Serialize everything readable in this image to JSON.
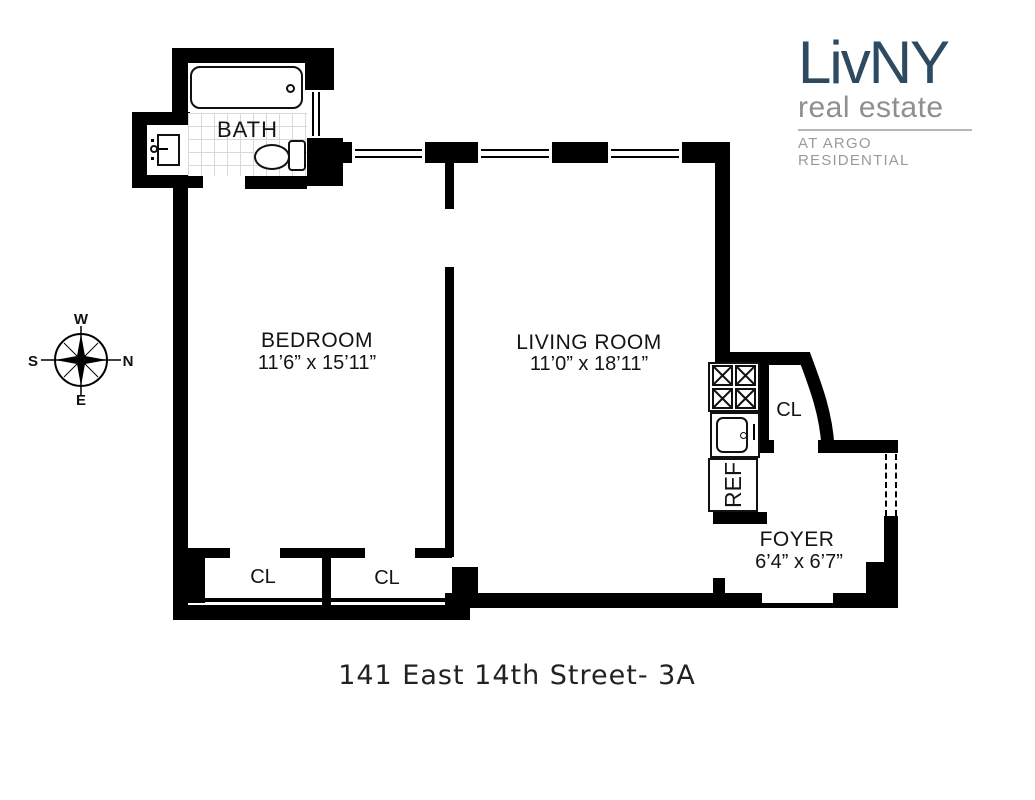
{
  "meta": {
    "background": "#ffffff",
    "wall_color": "#000000"
  },
  "logo": {
    "name": "LivNY",
    "tagline": "real estate",
    "subtitle": "AT ARGO RESIDENTIAL",
    "name_color": "#2d4a60",
    "tagline_color": "#8f8f8f",
    "subtitle_color": "#9a9a9a"
  },
  "compass": {
    "top": "W",
    "left": "S",
    "right": "N",
    "bottom": "E"
  },
  "plan": {
    "bath": {
      "label": "BATH"
    },
    "bedroom": {
      "label": "BEDROOM",
      "dimensions": "11’6” x 15’11”"
    },
    "living_room": {
      "label": "LIVING ROOM",
      "dimensions": "11’0” x 18’11”"
    },
    "foyer": {
      "label": "FOYER",
      "dimensions": "6’4” x 6’7”"
    },
    "closet_bedroom_left": {
      "label": "CL"
    },
    "closet_bedroom_right": {
      "label": "CL"
    },
    "closet_foyer": {
      "label": "CL"
    },
    "refrigerator": {
      "label": "REF"
    }
  },
  "footer": {
    "address": "141 East 14th Street- 3A"
  }
}
